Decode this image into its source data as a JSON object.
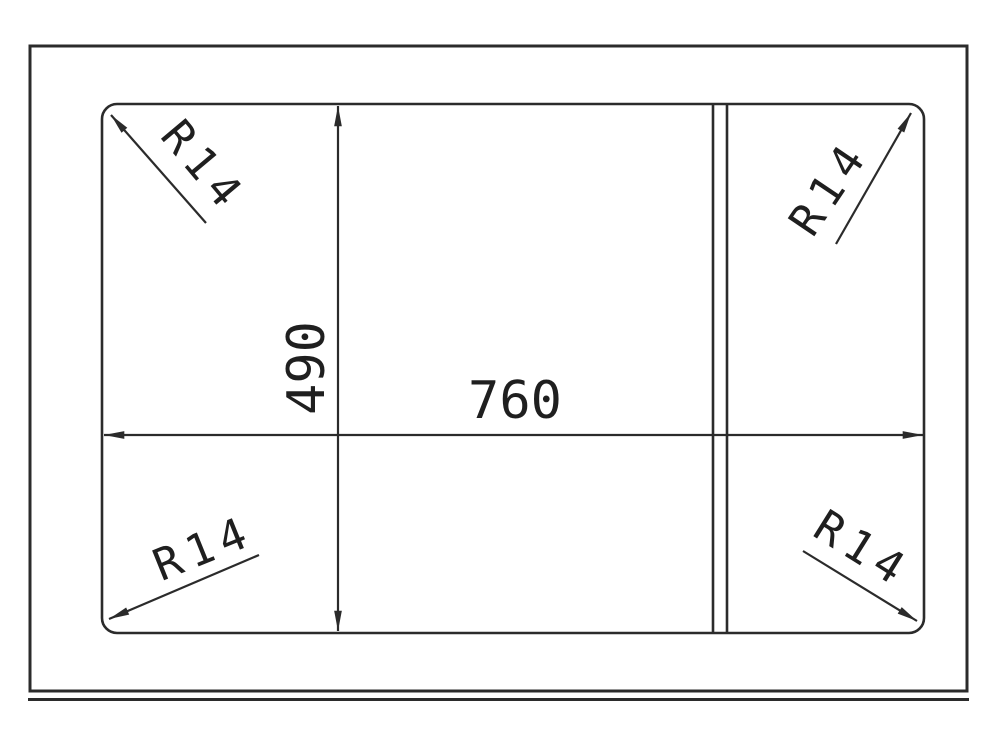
{
  "drawing": {
    "width_dimension": {
      "label": "760",
      "value": 760
    },
    "height_dimension": {
      "label": "490",
      "value": 490
    },
    "corner_radius": {
      "label": "R14",
      "value": 14
    },
    "radius_callouts": [
      {
        "position": "top-left",
        "label": "R14"
      },
      {
        "position": "top-right",
        "label": "R14"
      },
      {
        "position": "bottom-left",
        "label": "R14"
      },
      {
        "position": "bottom-right",
        "label": "R14"
      }
    ],
    "colors": {
      "line": "#2b2b2b",
      "text": "#1f1f1f",
      "background": "#ffffff"
    }
  }
}
